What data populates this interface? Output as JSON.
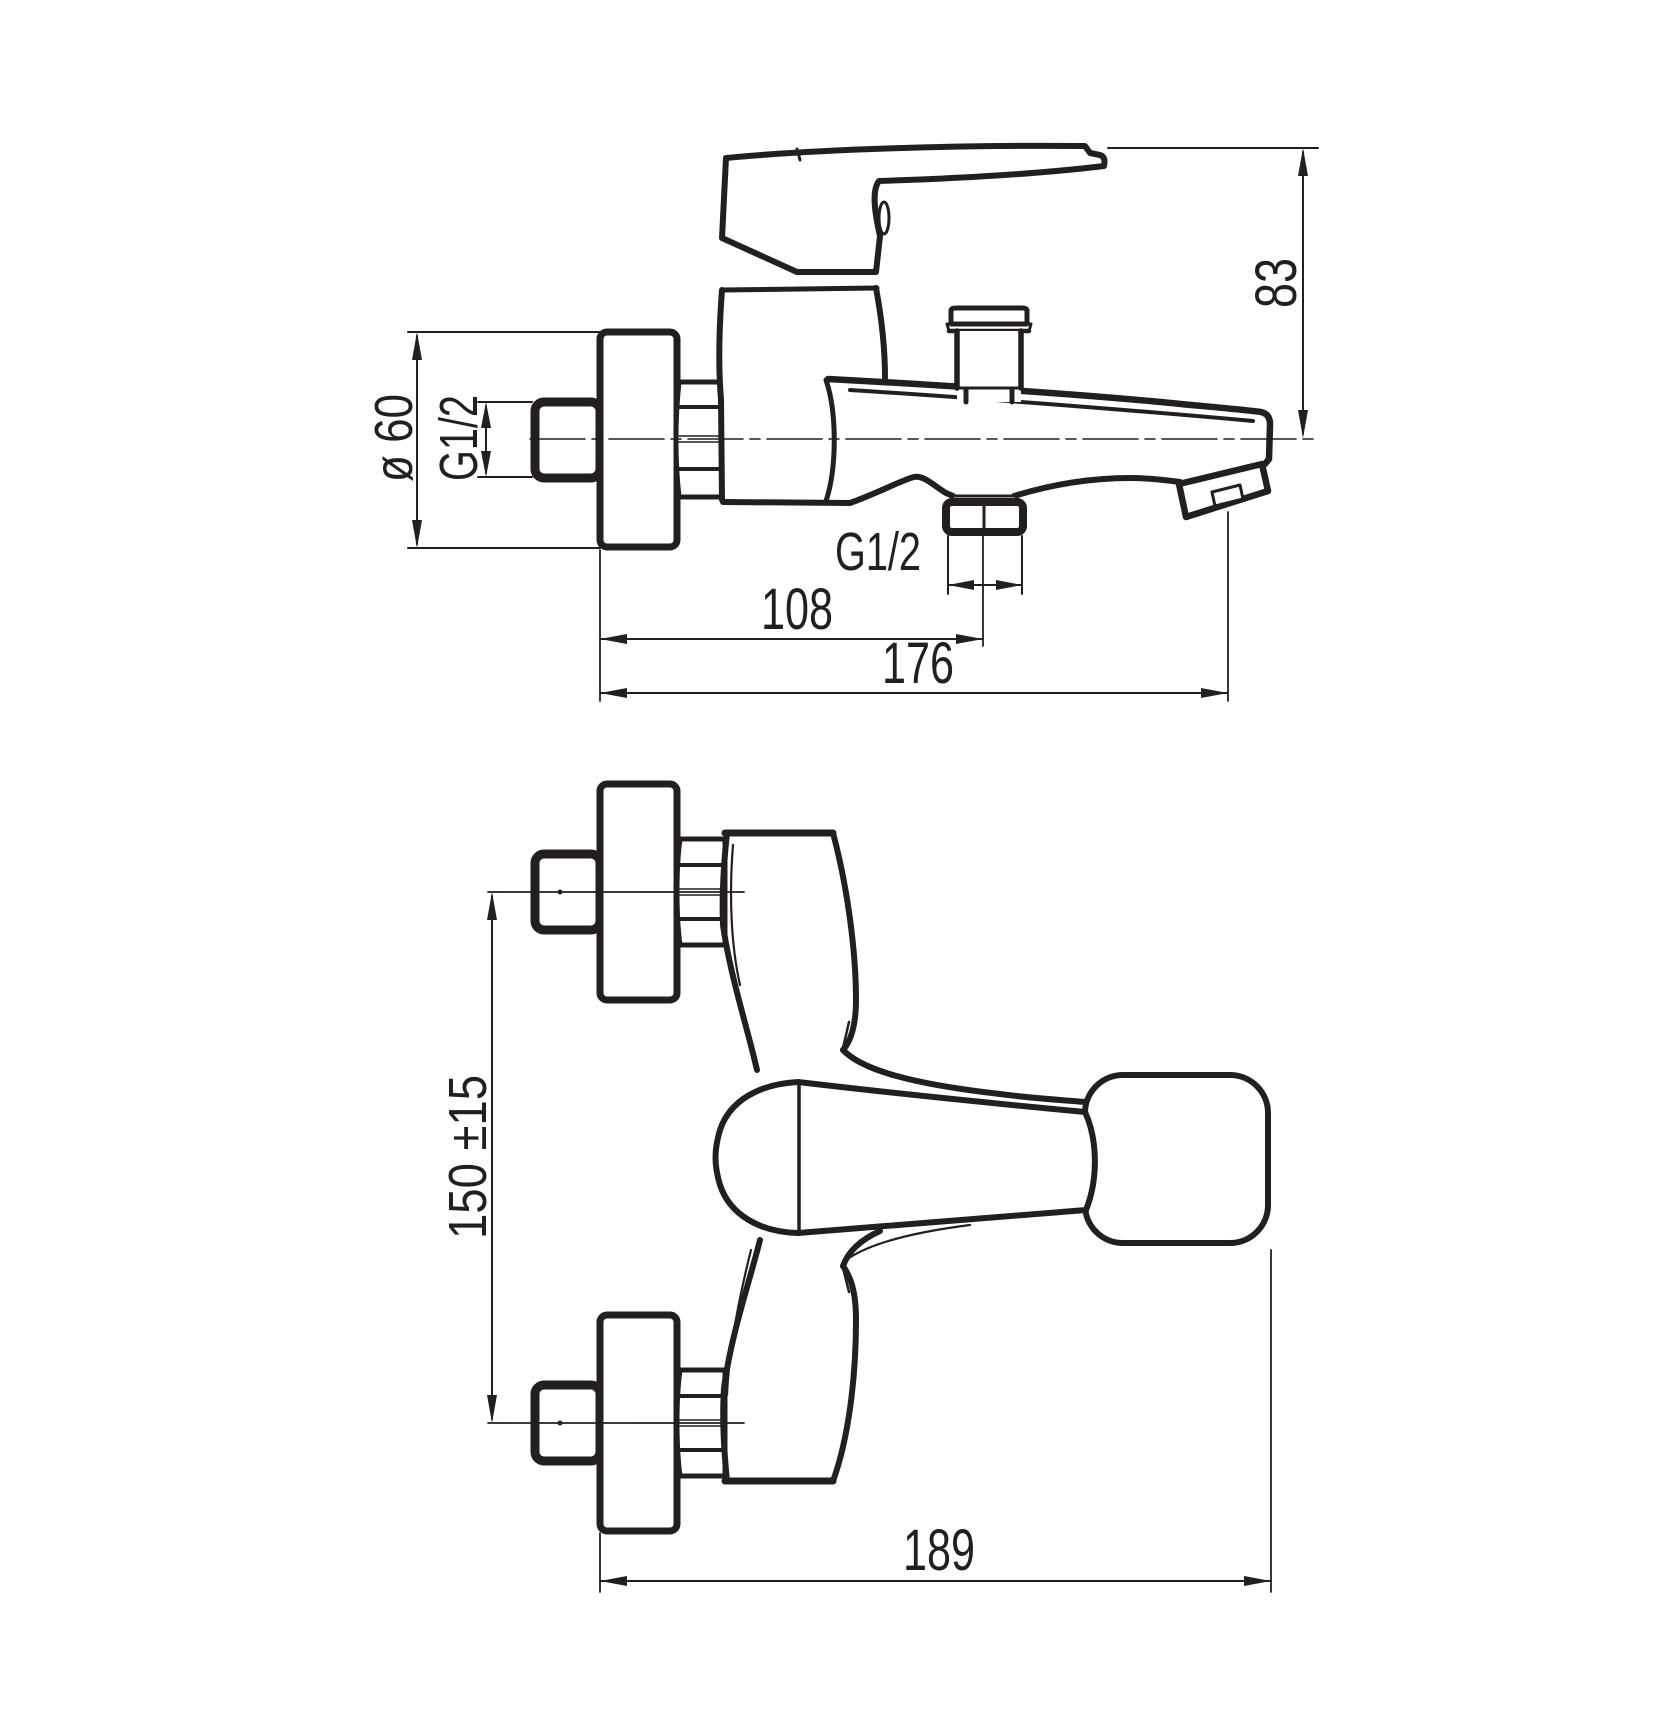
{
  "drawing": {
    "type": "technical-drawing",
    "colors": {
      "line": "#231f20",
      "background": "#ffffff"
    },
    "dimensions": {
      "spout_height": "83",
      "flange_diameter": "ø 60",
      "wall_thread": "G1/2",
      "outlet_thread": "G1/2",
      "wall_to_outlet": "108",
      "wall_to_spout_tip": "176",
      "connection_spacing": "150 ±15",
      "overall_depth": "189"
    }
  }
}
